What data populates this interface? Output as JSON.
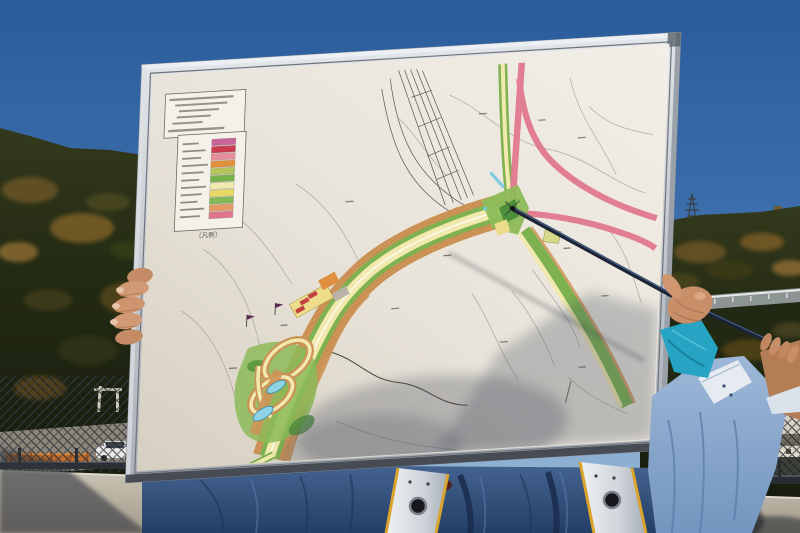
{
  "photo": {
    "board": {
      "legend": {
        "title": "〔凡例〕",
        "swatches": [
          {
            "name": "magenta",
            "color": "#c9639b"
          },
          {
            "name": "red",
            "color": "#cc3a50"
          },
          {
            "name": "salmon-pink",
            "color": "#e58e9c"
          },
          {
            "name": "orange",
            "color": "#e0913d"
          },
          {
            "name": "yellow-green",
            "color": "#b4c65a"
          },
          {
            "name": "green",
            "color": "#77b14c"
          },
          {
            "name": "pale-yellow",
            "color": "#f0eaae"
          },
          {
            "name": "yellow",
            "color": "#e9da64"
          },
          {
            "name": "mid-green",
            "color": "#84ba55"
          },
          {
            "name": "light-orange",
            "color": "#e59a63"
          },
          {
            "name": "rose",
            "color": "#e0748b"
          }
        ]
      },
      "frame_color": "#c3c8ce",
      "paper_color": "#e9e5dc",
      "map_palette": {
        "planned_road_pink": "#e17e92",
        "buffer_green": "#7eb250",
        "road_surface_yellow": "#f1e9ae",
        "earthwork_orange": "#cd9458",
        "water_cyan": "#8fd3e7",
        "building_red": "#c34040"
      }
    },
    "pointer": {
      "color": "#1b2335"
    },
    "environment": {
      "sky_top": "#2a5c9c",
      "sky_horizon": "#a9c3dc",
      "hill_foliage": "#2c3318",
      "concrete_wall": "#bcb6a8"
    },
    "people": {
      "holder_jacket_blue": "#33517e",
      "strap_silver": "#dde1e6",
      "pointer_holder_shirt_blue": "#8cabd0",
      "scarf_turquoise": "#27a3c4"
    }
  }
}
